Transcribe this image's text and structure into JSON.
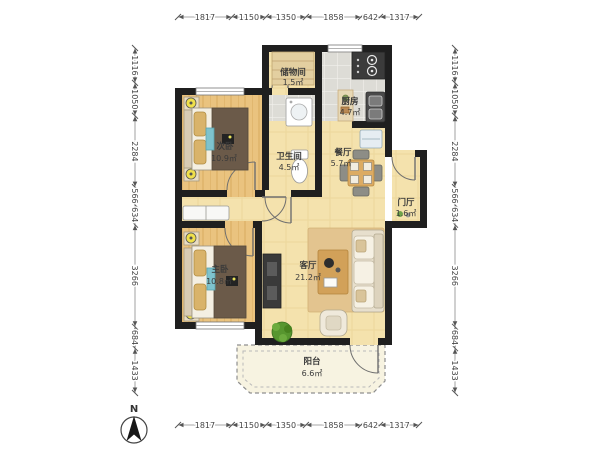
{
  "title": "apartment-floor-plan",
  "north": {
    "label": "N"
  },
  "rooms": {
    "storage": {
      "name": "储物间",
      "area": "1.5㎡"
    },
    "kitchen": {
      "name": "厨房",
      "area": "4.7㎡"
    },
    "bathroom": {
      "name": "卫生间",
      "area": "4.5㎡"
    },
    "dining": {
      "name": "餐厅",
      "area": "5.7㎡"
    },
    "entry": {
      "name": "门厅",
      "area": "1.6㎡"
    },
    "living": {
      "name": "客厅",
      "area": "21.2㎡"
    },
    "secondary_bedroom": {
      "name": "次卧",
      "area": "10.9㎡"
    },
    "master_bedroom": {
      "name": "主卧",
      "area": "10.8㎡"
    },
    "balcony": {
      "name": "阳台",
      "area": "6.6㎡"
    }
  },
  "dimensions_mm": {
    "top": [
      1817,
      1150,
      1350,
      1858,
      642,
      1317
    ],
    "bottom": [
      1817,
      1150,
      1350,
      1858,
      642,
      1317
    ],
    "left": [
      1116,
      1050,
      2284,
      566,
      634,
      3266,
      684,
      1433
    ],
    "right": [
      1116,
      1050,
      2284,
      566,
      634,
      3266,
      684,
      1433
    ]
  },
  "colors": {
    "wall": "#1f1f1f",
    "bedroom_floor": "#eac37f",
    "living_floor": "#f4e2ad",
    "tile_floor": "#dddcd6",
    "balcony_floor": "#f7f3e1",
    "accent_lamp": "#f0e04a",
    "plant": "#57962f"
  }
}
